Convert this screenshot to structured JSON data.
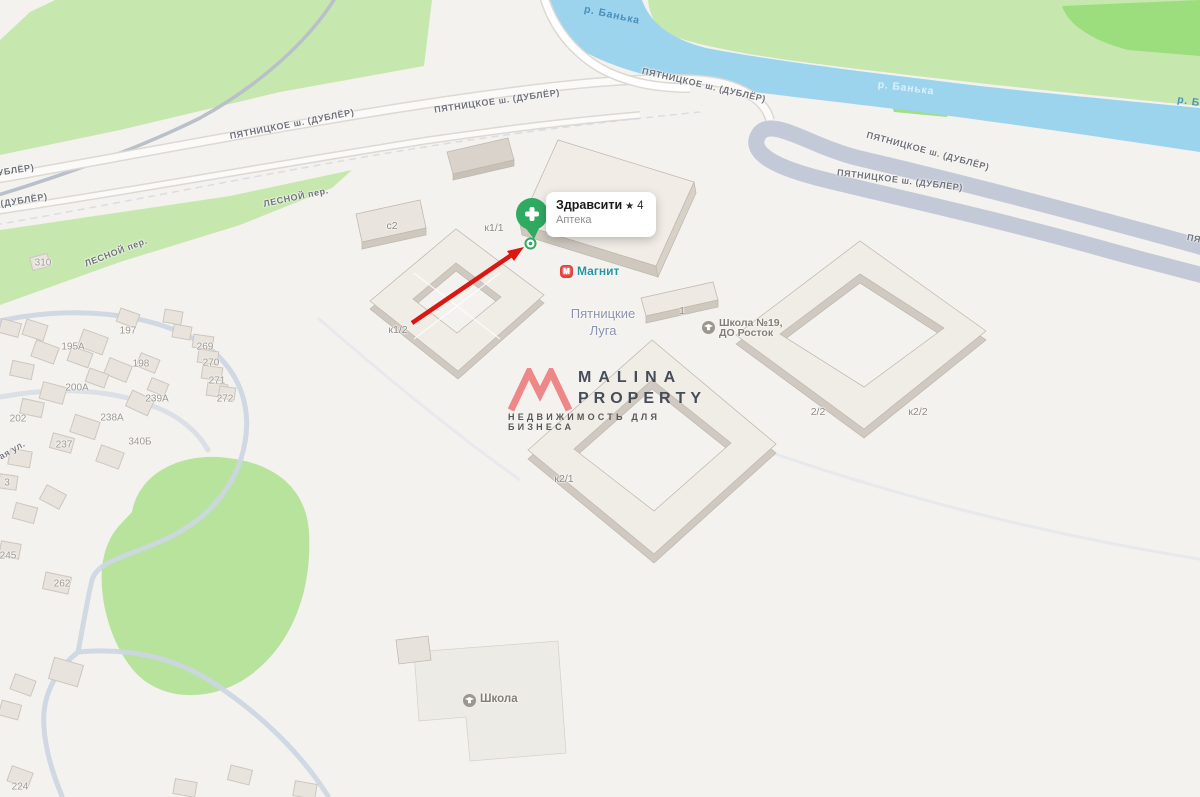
{
  "pin_card": {
    "title": "Здравсити",
    "star": "★",
    "rating": "4",
    "category": "Аптека"
  },
  "pois": {
    "magnit": {
      "icon_letter": "М",
      "label": "Магнит"
    },
    "school19": {
      "line1": "Школа №19,",
      "line2": "ДО Росток"
    },
    "school": {
      "label": "Школа"
    }
  },
  "district": {
    "line1": "Пятницкие",
    "line2": "Луга"
  },
  "watermark": {
    "brand_line1": "MALINA",
    "brand_line2": "PROPERTY",
    "tagline": "НЕДВИЖИМОСТЬ ДЛЯ БИЗНЕСА"
  },
  "colors": {
    "pin_green": "#2fab61",
    "arrow_red": "#dc1712",
    "river_blue": "#9cd4ee",
    "park_green": "#c6e8ae",
    "magnit_red": "#e6403d",
    "logo_coral": "#ee8181"
  },
  "labels": [
    {
      "name": "road-label-pyatnitskoe-1",
      "type": "road",
      "text": "ПЯТНИЦКОЕ ш. (ДУБЛЁР)",
      "x": 292,
      "y": 124,
      "r": -11
    },
    {
      "name": "road-label-pyatnitskoe-2",
      "type": "road",
      "text": "ПЯТНИЦКОЕ ш. (ДУБЛЁР)",
      "x": 497,
      "y": 101,
      "r": -8
    },
    {
      "name": "road-label-pyatnitskoe-3",
      "type": "road",
      "text": "ПЯТНИЦКОЕ ш. (ДУБЛЁР)",
      "x": 704,
      "y": 85,
      "r": 13
    },
    {
      "name": "road-label-pyatnitskoe-4",
      "type": "road",
      "text": "ПЯТНИЦКОЕ ш. (ДУБЛЁР)",
      "x": 928,
      "y": 151,
      "r": 15
    },
    {
      "name": "road-label-pyatnitskoe-5",
      "type": "road",
      "text": "ПЯТНИЦКОЕ ш. (ДУБЛЁР)",
      "x": 900,
      "y": 180,
      "r": 7
    },
    {
      "name": "road-label-pyatnitskoe-partial-right",
      "type": "road",
      "text": "ПЯТ",
      "x": 1197,
      "y": 239,
      "r": 12
    },
    {
      "name": "road-label-dubler-partial-1",
      "type": "road",
      "text": "УБЛЁР)",
      "x": 16,
      "y": 170,
      "r": -9
    },
    {
      "name": "road-label-dubler-partial-2",
      "type": "road",
      "text": "(ДУБЛЁР)",
      "x": 24,
      "y": 200,
      "r": -9
    },
    {
      "name": "road-label-lesnoy-1",
      "type": "road",
      "text": "ЛЕСНОЙ пер.",
      "x": 296,
      "y": 197,
      "r": -12
    },
    {
      "name": "road-label-lesnoy-2",
      "type": "road",
      "text": "ЛЕСНОЙ пер.",
      "x": 116,
      "y": 252,
      "r": -21
    },
    {
      "name": "street-label-partial",
      "type": "street",
      "text": "ая ул.",
      "x": 12,
      "y": 450,
      "r": -30
    },
    {
      "name": "river-label-banka-1",
      "type": "river",
      "text": "р. Банька",
      "x": 612,
      "y": 15,
      "r": 12
    },
    {
      "name": "river-label-banka-2",
      "type": "river",
      "text": "р. Банька",
      "x": 906,
      "y": 88,
      "r": 7,
      "color": "#ddeffa"
    },
    {
      "name": "river-label-banka-partial",
      "type": "river",
      "text": "р. Ба",
      "x": 1192,
      "y": 102,
      "r": 10,
      "color": "#4e93bb"
    },
    {
      "name": "building-label-s2",
      "type": "bcode",
      "text": "с2",
      "x": 392,
      "y": 226
    },
    {
      "name": "building-label-k1-1",
      "type": "bcode",
      "text": "к1/1",
      "x": 494,
      "y": 228
    },
    {
      "name": "building-label-k1-2",
      "type": "bcode",
      "text": "к1/2",
      "x": 398,
      "y": 330
    },
    {
      "name": "building-label-k2-1",
      "type": "bcode",
      "text": "к2/1",
      "x": 564,
      "y": 479
    },
    {
      "name": "building-label-2-2",
      "type": "bcode",
      "text": "2/2",
      "x": 818,
      "y": 412
    },
    {
      "name": "building-label-k2-2",
      "type": "bcode",
      "text": "к2/2",
      "x": 918,
      "y": 412
    },
    {
      "name": "building-label-1",
      "type": "bcode",
      "text": "1",
      "x": 682,
      "y": 311
    },
    {
      "name": "house-number-310",
      "type": "house",
      "text": "310",
      "x": 43,
      "y": 263
    },
    {
      "name": "house-number-197",
      "type": "house",
      "text": "197",
      "x": 128,
      "y": 331
    },
    {
      "name": "house-number-195a",
      "type": "house",
      "text": "195А",
      "x": 73,
      "y": 347
    },
    {
      "name": "house-number-198",
      "type": "house",
      "text": "198",
      "x": 141,
      "y": 364
    },
    {
      "name": "house-number-269",
      "type": "house",
      "text": "269",
      "x": 205,
      "y": 347
    },
    {
      "name": "house-number-270",
      "type": "house",
      "text": "270",
      "x": 211,
      "y": 363
    },
    {
      "name": "house-number-271",
      "type": "house",
      "text": "271",
      "x": 217,
      "y": 381
    },
    {
      "name": "house-number-272",
      "type": "house",
      "text": "272",
      "x": 225,
      "y": 399
    },
    {
      "name": "house-number-200a",
      "type": "house",
      "text": "200А",
      "x": 77,
      "y": 388
    },
    {
      "name": "house-number-239a",
      "type": "house",
      "text": "239А",
      "x": 157,
      "y": 399
    },
    {
      "name": "house-number-238a",
      "type": "house",
      "text": "238А",
      "x": 112,
      "y": 418
    },
    {
      "name": "house-number-202",
      "type": "house",
      "text": "202",
      "x": 18,
      "y": 419
    },
    {
      "name": "house-number-237",
      "type": "house",
      "text": "237",
      "x": 64,
      "y": 445
    },
    {
      "name": "house-number-340b",
      "type": "house",
      "text": "340Б",
      "x": 140,
      "y": 442
    },
    {
      "name": "house-number-3",
      "type": "house",
      "text": "3",
      "x": 7,
      "y": 483
    },
    {
      "name": "house-number-245",
      "type": "house",
      "text": "245",
      "x": 8,
      "y": 556
    },
    {
      "name": "house-number-262",
      "type": "house",
      "text": "262",
      "x": 62,
      "y": 584
    },
    {
      "name": "house-number-224",
      "type": "house",
      "text": "224",
      "x": 20,
      "y": 787
    }
  ]
}
